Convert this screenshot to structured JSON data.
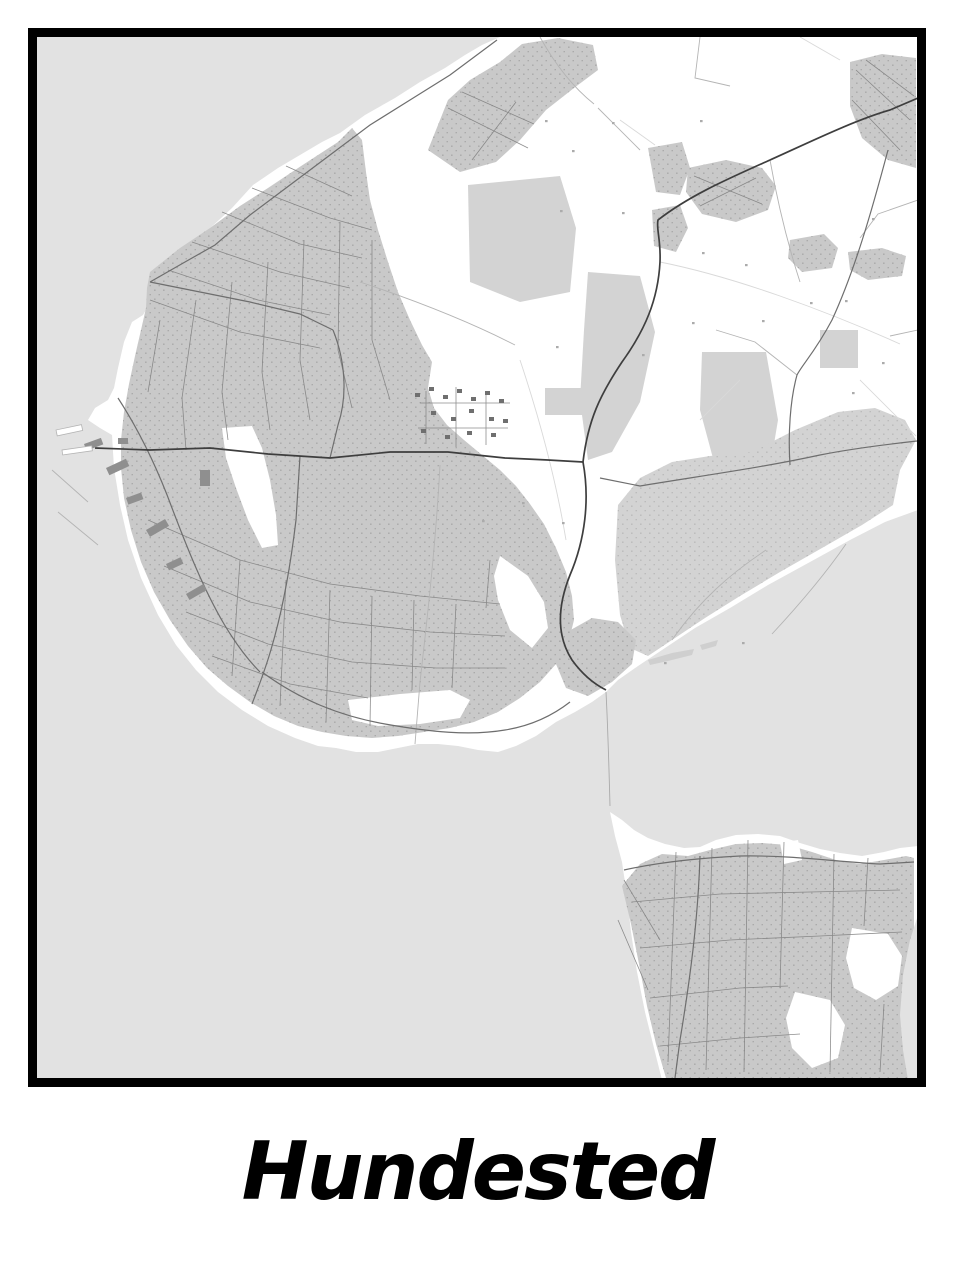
{
  "poster": {
    "title": "Hundested",
    "type": "minimalist street map poster"
  },
  "colors": {
    "page_bg": "#ffffff",
    "frame": "#000000",
    "title": "#000000",
    "water": "#e2e2e2",
    "land": "#ffffff",
    "urban": "#c9c9c9",
    "natural": "#d3d3d3",
    "shoal": "#cfcfcf",
    "speckle": "#9d9d9d",
    "street": "#828282",
    "road_major": "#3e3e3e",
    "road_medium": "#6e6e6e",
    "road_minor": "#b4b4b4",
    "field_line": "#d9d9d9",
    "building": "#6f6f6f",
    "harbor_building": "#8f8f8f",
    "pier": "#ffffff",
    "ferry": "#aaaaaa"
  }
}
